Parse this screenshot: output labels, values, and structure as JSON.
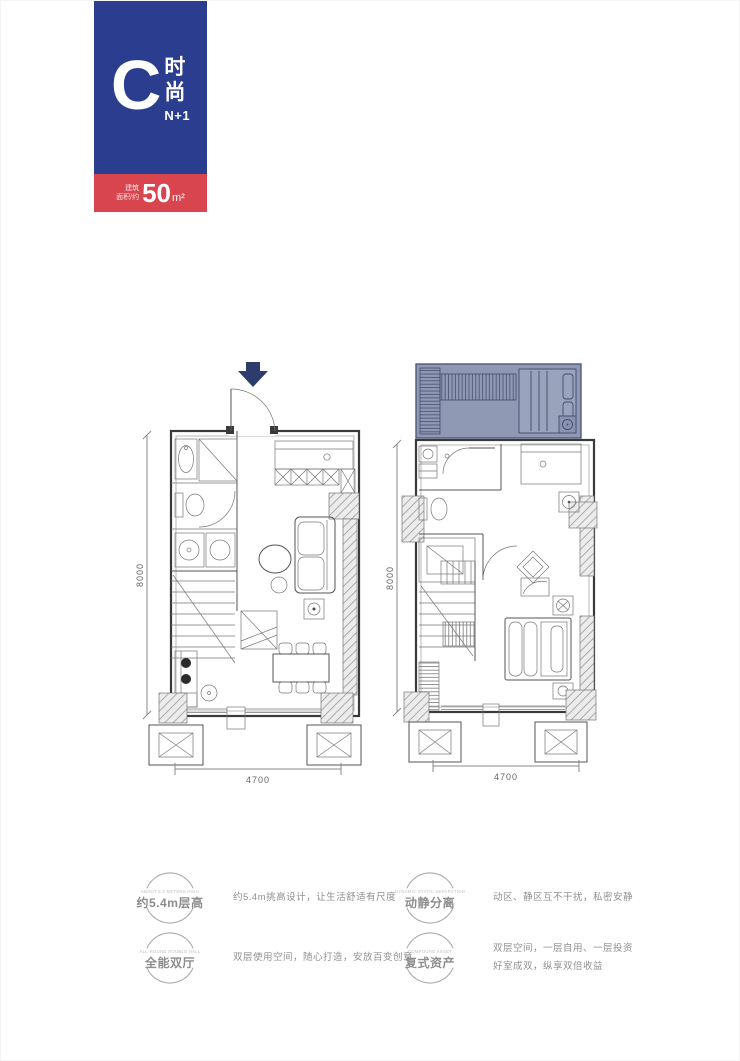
{
  "badge": {
    "letter": "C",
    "name": "时尚",
    "sub": "N+1",
    "area_label_1": "建筑",
    "area_label_2": "面积/约",
    "area_value": "50",
    "area_unit": "m²"
  },
  "plans": {
    "left": {
      "dim_height": "8000",
      "dim_width": "4700"
    },
    "right": {
      "dim_height": "8000",
      "dim_width": "4700"
    }
  },
  "features": [
    {
      "en": "ABOUT 5.4 METERS HIGH",
      "label": "约5.4m层高",
      "desc": [
        "约5.4m挑高设计，让生活舒适有尺度"
      ]
    },
    {
      "en": "DYNAMIC STATIC SEPARATION",
      "label": "动静分离",
      "desc": [
        "动区、静区互不干扰，私密安静"
      ]
    },
    {
      "en": "ALL-ROUND DOUBLE HALL",
      "label": "全能双厅",
      "desc": [
        "双层使用空间，随心打造，安放百变创意"
      ]
    },
    {
      "en": "COMPOUND ASSET",
      "label": "复式资产",
      "desc": [
        "双层空间，一层自用、一层投资",
        "好室成双，纵享双倍收益"
      ]
    }
  ],
  "colors": {
    "blue": "#2b3d8f",
    "red": "#d8454e",
    "navy": "#2c3c6d",
    "loft": "#8a94b0",
    "gray_text": "#909090"
  }
}
